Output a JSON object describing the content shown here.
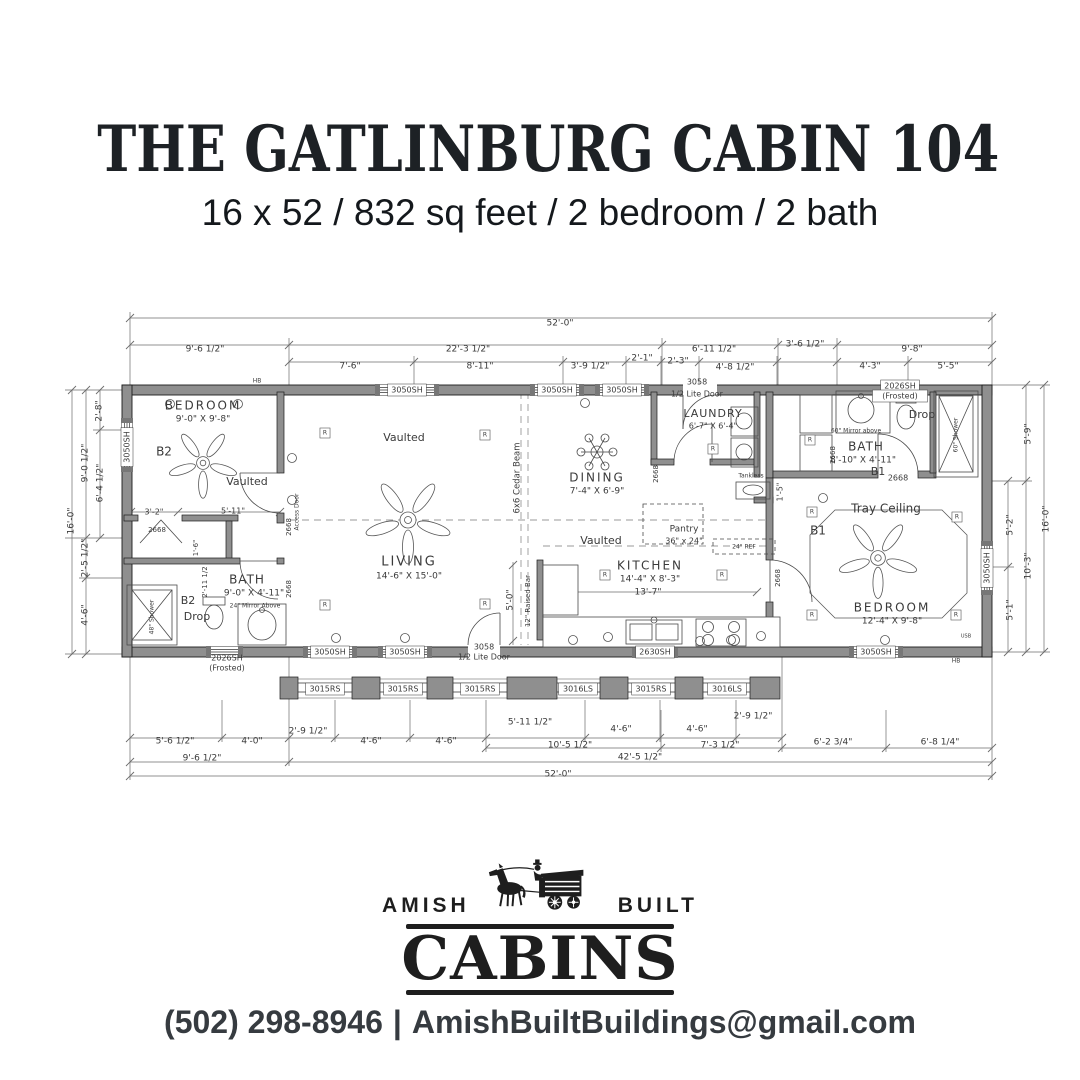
{
  "header": {
    "title": "THE GATLINBURG CABIN 104",
    "subtitle": "16 x 52 / 832 sq feet / 2 bedroom / 2 bath"
  },
  "footer": {
    "logo_left": "AMISH",
    "logo_right": "BUILT",
    "logo_main": "CABINS",
    "phone": "(502) 298-8946",
    "separator": "|",
    "email": "AmishBuiltBuildings@gmail.com"
  },
  "plan": {
    "labels": [
      {
        "t": "52'-0\"",
        "x": 560,
        "y": 323
      },
      {
        "t": "9'-6 1/2\"",
        "x": 205,
        "y": 349
      },
      {
        "t": "22'-3 1/2\"",
        "x": 468,
        "y": 349
      },
      {
        "t": "6'-11 1/2\"",
        "x": 714,
        "y": 349
      },
      {
        "t": "3'-6 1/2\"",
        "x": 805,
        "y": 344
      },
      {
        "t": "9'-8\"",
        "x": 912,
        "y": 349
      },
      {
        "t": "7'-6\"",
        "x": 350,
        "y": 366
      },
      {
        "t": "8'-11\"",
        "x": 480,
        "y": 366
      },
      {
        "t": "3'-9 1/2\"",
        "x": 590,
        "y": 366
      },
      {
        "t": "2'-1\"",
        "x": 642,
        "y": 358
      },
      {
        "t": "2'-3\"",
        "x": 678,
        "y": 361
      },
      {
        "t": "4'-8 1/2\"",
        "x": 735,
        "y": 367
      },
      {
        "t": "4'-3\"",
        "x": 870,
        "y": 366
      },
      {
        "t": "5'-5\"",
        "x": 948,
        "y": 366
      },
      {
        "t": "2'-8\"",
        "x": 99,
        "y": 411,
        "r": -90
      },
      {
        "t": "9'-0 1/2\"",
        "x": 85,
        "y": 463,
        "r": -90
      },
      {
        "t": "6'-4 1/2\"",
        "x": 100,
        "y": 483,
        "r": -90
      },
      {
        "t": "16'-0\"",
        "x": 71,
        "y": 521,
        "r": -90
      },
      {
        "t": "2'-5 1/2\"",
        "x": 85,
        "y": 558,
        "r": -90
      },
      {
        "t": "4'-6\"",
        "x": 85,
        "y": 615,
        "r": -90
      },
      {
        "t": "5'-9\"",
        "x": 1028,
        "y": 434,
        "r": -90
      },
      {
        "t": "5'-2\"",
        "x": 1010,
        "y": 525,
        "r": -90
      },
      {
        "t": "10'-3\"",
        "x": 1028,
        "y": 566,
        "r": -90
      },
      {
        "t": "5'-1\"",
        "x": 1010,
        "y": 610,
        "r": -90
      },
      {
        "t": "16'-0\"",
        "x": 1046,
        "y": 519,
        "r": -90
      },
      {
        "t": "5'-6 1/2\"",
        "x": 175,
        "y": 741
      },
      {
        "t": "4'-0\"",
        "x": 252,
        "y": 741
      },
      {
        "t": "2'-9 1/2\"",
        "x": 308,
        "y": 731
      },
      {
        "t": "4'-6\"",
        "x": 371,
        "y": 741
      },
      {
        "t": "4'-6\"",
        "x": 446,
        "y": 741
      },
      {
        "t": "5'-11 1/2\"",
        "x": 530,
        "y": 722
      },
      {
        "t": "4'-6\"",
        "x": 621,
        "y": 729
      },
      {
        "t": "4'-6\"",
        "x": 697,
        "y": 729
      },
      {
        "t": "2'-9 1/2\"",
        "x": 753,
        "y": 716
      },
      {
        "t": "10'-5 1/2\"",
        "x": 570,
        "y": 745
      },
      {
        "t": "7'-3 1/2\"",
        "x": 720,
        "y": 745
      },
      {
        "t": "6'-2 3/4\"",
        "x": 833,
        "y": 742
      },
      {
        "t": "6'-8 1/4\"",
        "x": 940,
        "y": 742
      },
      {
        "t": "9'-6 1/2\"",
        "x": 202,
        "y": 758
      },
      {
        "t": "42'-5 1/2\"",
        "x": 640,
        "y": 757
      },
      {
        "t": "52'-0\"",
        "x": 558,
        "y": 774
      },
      {
        "t": "3050SH",
        "x": 407,
        "y": 390,
        "b": 1,
        "s": 8
      },
      {
        "t": "3050SH",
        "x": 557,
        "y": 390,
        "b": 1,
        "s": 8
      },
      {
        "t": "3050SH",
        "x": 622,
        "y": 390,
        "b": 1,
        "s": 8
      },
      {
        "t": "3058",
        "x": 697,
        "y": 382,
        "s": 8
      },
      {
        "t": "1/2 Lite Door",
        "x": 697,
        "y": 394,
        "s": 8
      },
      {
        "t": "2026SH",
        "x": 900,
        "y": 386,
        "b": 1,
        "s": 8
      },
      {
        "t": "(Frosted)",
        "x": 900,
        "y": 396,
        "b": 1,
        "s": 8
      },
      {
        "t": "3050SH",
        "x": 127,
        "y": 447,
        "r": -90,
        "b": 1,
        "s": 8
      },
      {
        "t": "3050SH",
        "x": 987,
        "y": 568,
        "r": -90,
        "b": 1,
        "s": 8
      },
      {
        "t": "2026SH",
        "x": 227,
        "y": 658,
        "s": 8
      },
      {
        "t": "(Frosted)",
        "x": 227,
        "y": 668,
        "s": 8
      },
      {
        "t": "3050SH",
        "x": 330,
        "y": 652,
        "b": 1,
        "s": 8
      },
      {
        "t": "3050SH",
        "x": 405,
        "y": 652,
        "b": 1,
        "s": 8
      },
      {
        "t": "3058",
        "x": 484,
        "y": 647,
        "s": 8
      },
      {
        "t": "1/2 Lite Door",
        "x": 484,
        "y": 657,
        "s": 8
      },
      {
        "t": "2630SH",
        "x": 655,
        "y": 652,
        "b": 1,
        "s": 8
      },
      {
        "t": "3050SH",
        "x": 876,
        "y": 652,
        "b": 1,
        "s": 8
      },
      {
        "t": "3015RS",
        "x": 325,
        "y": 689,
        "b": 1,
        "s": 8
      },
      {
        "t": "3015RS",
        "x": 403,
        "y": 689,
        "b": 1,
        "s": 8
      },
      {
        "t": "3015RS",
        "x": 480,
        "y": 689,
        "b": 1,
        "s": 8
      },
      {
        "t": "3016LS",
        "x": 578,
        "y": 689,
        "b": 1,
        "s": 8
      },
      {
        "t": "3015RS",
        "x": 651,
        "y": 689,
        "b": 1,
        "s": 8
      },
      {
        "t": "3016LS",
        "x": 727,
        "y": 689,
        "b": 1,
        "s": 8
      },
      {
        "t": "BEDROOM",
        "x": 203,
        "y": 406,
        "s": 12,
        "ls": 2
      },
      {
        "t": "9'-0\" X 9'-8\"",
        "x": 203,
        "y": 419,
        "s": 9
      },
      {
        "t": "B2",
        "x": 164,
        "y": 452,
        "s": 12
      },
      {
        "t": "Vaulted",
        "x": 247,
        "y": 482,
        "s": 11
      },
      {
        "t": "Vaulted",
        "x": 404,
        "y": 438,
        "s": 11
      },
      {
        "t": "LIVING",
        "x": 409,
        "y": 562,
        "s": 13,
        "ls": 2
      },
      {
        "t": "14'-6\" X 15'-0\"",
        "x": 409,
        "y": 576,
        "s": 9
      },
      {
        "t": "DINING",
        "x": 597,
        "y": 478,
        "s": 12,
        "ls": 2
      },
      {
        "t": "7'-4\" X 6'-9\"",
        "x": 597,
        "y": 491,
        "s": 9
      },
      {
        "t": "LAUNDRY",
        "x": 713,
        "y": 414,
        "s": 11,
        "ls": 1
      },
      {
        "t": "6'-7\" X 6'-4\"",
        "x": 713,
        "y": 426,
        "s": 8
      },
      {
        "t": "Vaulted",
        "x": 601,
        "y": 541,
        "s": 11
      },
      {
        "t": "KITCHEN",
        "x": 650,
        "y": 566,
        "s": 12,
        "ls": 2
      },
      {
        "t": "14'-4\" X 8'-3\"",
        "x": 650,
        "y": 579,
        "s": 9
      },
      {
        "t": "13'-7\"",
        "x": 648,
        "y": 592,
        "s": 9
      },
      {
        "t": "BATH",
        "x": 247,
        "y": 580,
        "s": 12,
        "ls": 1
      },
      {
        "t": "9'-0\" X 4'-11\"",
        "x": 254,
        "y": 593,
        "s": 9
      },
      {
        "t": "B2",
        "x": 188,
        "y": 601,
        "s": 11
      },
      {
        "t": "Drop",
        "x": 197,
        "y": 617,
        "s": 11
      },
      {
        "t": "BATH",
        "x": 866,
        "y": 447,
        "s": 12,
        "ls": 1
      },
      {
        "t": "8'-10\" X 4'-11\"",
        "x": 863,
        "y": 460,
        "s": 9
      },
      {
        "t": "B1",
        "x": 878,
        "y": 472,
        "s": 11
      },
      {
        "t": "Drop",
        "x": 922,
        "y": 415,
        "s": 11
      },
      {
        "t": "Tray Ceiling",
        "x": 886,
        "y": 509,
        "s": 12
      },
      {
        "t": "B1",
        "x": 818,
        "y": 531,
        "s": 12
      },
      {
        "t": "BEDROOM",
        "x": 892,
        "y": 608,
        "s": 12,
        "ls": 2
      },
      {
        "t": "12'-4\" X 9'-8\"",
        "x": 892,
        "y": 621,
        "s": 9
      },
      {
        "t": "3'-2\"",
        "x": 154,
        "y": 512,
        "s": 8
      },
      {
        "t": "5'-11\"",
        "x": 233,
        "y": 511,
        "s": 8
      },
      {
        "t": "1'-6\"",
        "x": 196,
        "y": 548,
        "r": -90,
        "s": 7
      },
      {
        "t": "2'-11 1/2",
        "x": 205,
        "y": 582,
        "r": -90,
        "s": 7
      },
      {
        "t": "2668",
        "x": 157,
        "y": 530,
        "s": 7
      },
      {
        "t": "2668",
        "x": 289,
        "y": 527,
        "r": -90,
        "s": 7
      },
      {
        "t": "2668",
        "x": 289,
        "y": 589,
        "r": -90,
        "s": 7
      },
      {
        "t": "Access Door",
        "x": 297,
        "y": 512,
        "r": -90,
        "s": 6
      },
      {
        "t": "6x6 Cedar Beam",
        "x": 517,
        "y": 478,
        "r": -90,
        "s": 8.5
      },
      {
        "t": "5'-0\"",
        "x": 510,
        "y": 600,
        "r": -90,
        "s": 9
      },
      {
        "t": "12\" Raised Bar",
        "x": 528,
        "y": 601,
        "r": -90,
        "s": 7
      },
      {
        "t": "Pantry",
        "x": 684,
        "y": 529,
        "s": 9
      },
      {
        "t": "36\" x 24\"",
        "x": 684,
        "y": 541,
        "s": 8
      },
      {
        "t": "24\" REF",
        "x": 744,
        "y": 547,
        "s": 6
      },
      {
        "t": "Tankless",
        "x": 751,
        "y": 476,
        "s": 6
      },
      {
        "t": "2668",
        "x": 656,
        "y": 474,
        "r": -90,
        "s": 7
      },
      {
        "t": "2668",
        "x": 778,
        "y": 578,
        "r": -90,
        "s": 7
      },
      {
        "t": "2668",
        "x": 833,
        "y": 455,
        "r": -90,
        "s": 7
      },
      {
        "t": "2668",
        "x": 898,
        "y": 478,
        "s": 8
      },
      {
        "t": "1'-5\"",
        "x": 780,
        "y": 492,
        "r": -90,
        "s": 8
      },
      {
        "t": "24\" Mirror Above",
        "x": 255,
        "y": 606,
        "s": 6
      },
      {
        "t": "60\" Mirror above",
        "x": 856,
        "y": 431,
        "s": 6
      },
      {
        "t": "48\" Shower",
        "x": 152,
        "y": 617,
        "r": -90,
        "s": 6
      },
      {
        "t": "60\" Shower",
        "x": 956,
        "y": 435,
        "r": -90,
        "s": 6
      },
      {
        "t": "HB",
        "x": 257,
        "y": 381,
        "s": 6
      },
      {
        "t": "HB",
        "x": 956,
        "y": 661,
        "s": 6
      },
      {
        "t": "USB",
        "x": 966,
        "y": 636,
        "s": 5
      },
      {
        "t": "R",
        "x": 325,
        "y": 433,
        "b": 1,
        "s": 6
      },
      {
        "t": "R",
        "x": 485,
        "y": 435,
        "b": 1,
        "s": 6
      },
      {
        "t": "R",
        "x": 325,
        "y": 605,
        "b": 1,
        "s": 6
      },
      {
        "t": "R",
        "x": 485,
        "y": 604,
        "b": 1,
        "s": 6
      },
      {
        "t": "R",
        "x": 605,
        "y": 575,
        "b": 1,
        "s": 6
      },
      {
        "t": "R",
        "x": 722,
        "y": 575,
        "b": 1,
        "s": 6
      },
      {
        "t": "R",
        "x": 713,
        "y": 449,
        "b": 1,
        "s": 6
      },
      {
        "t": "R",
        "x": 812,
        "y": 512,
        "b": 1,
        "s": 6
      },
      {
        "t": "R",
        "x": 957,
        "y": 517,
        "b": 1,
        "s": 6
      },
      {
        "t": "R",
        "x": 812,
        "y": 615,
        "b": 1,
        "s": 6
      },
      {
        "t": "R",
        "x": 956,
        "y": 615,
        "b": 1,
        "s": 6
      },
      {
        "t": "R",
        "x": 810,
        "y": 440,
        "b": 1,
        "s": 6
      }
    ]
  }
}
